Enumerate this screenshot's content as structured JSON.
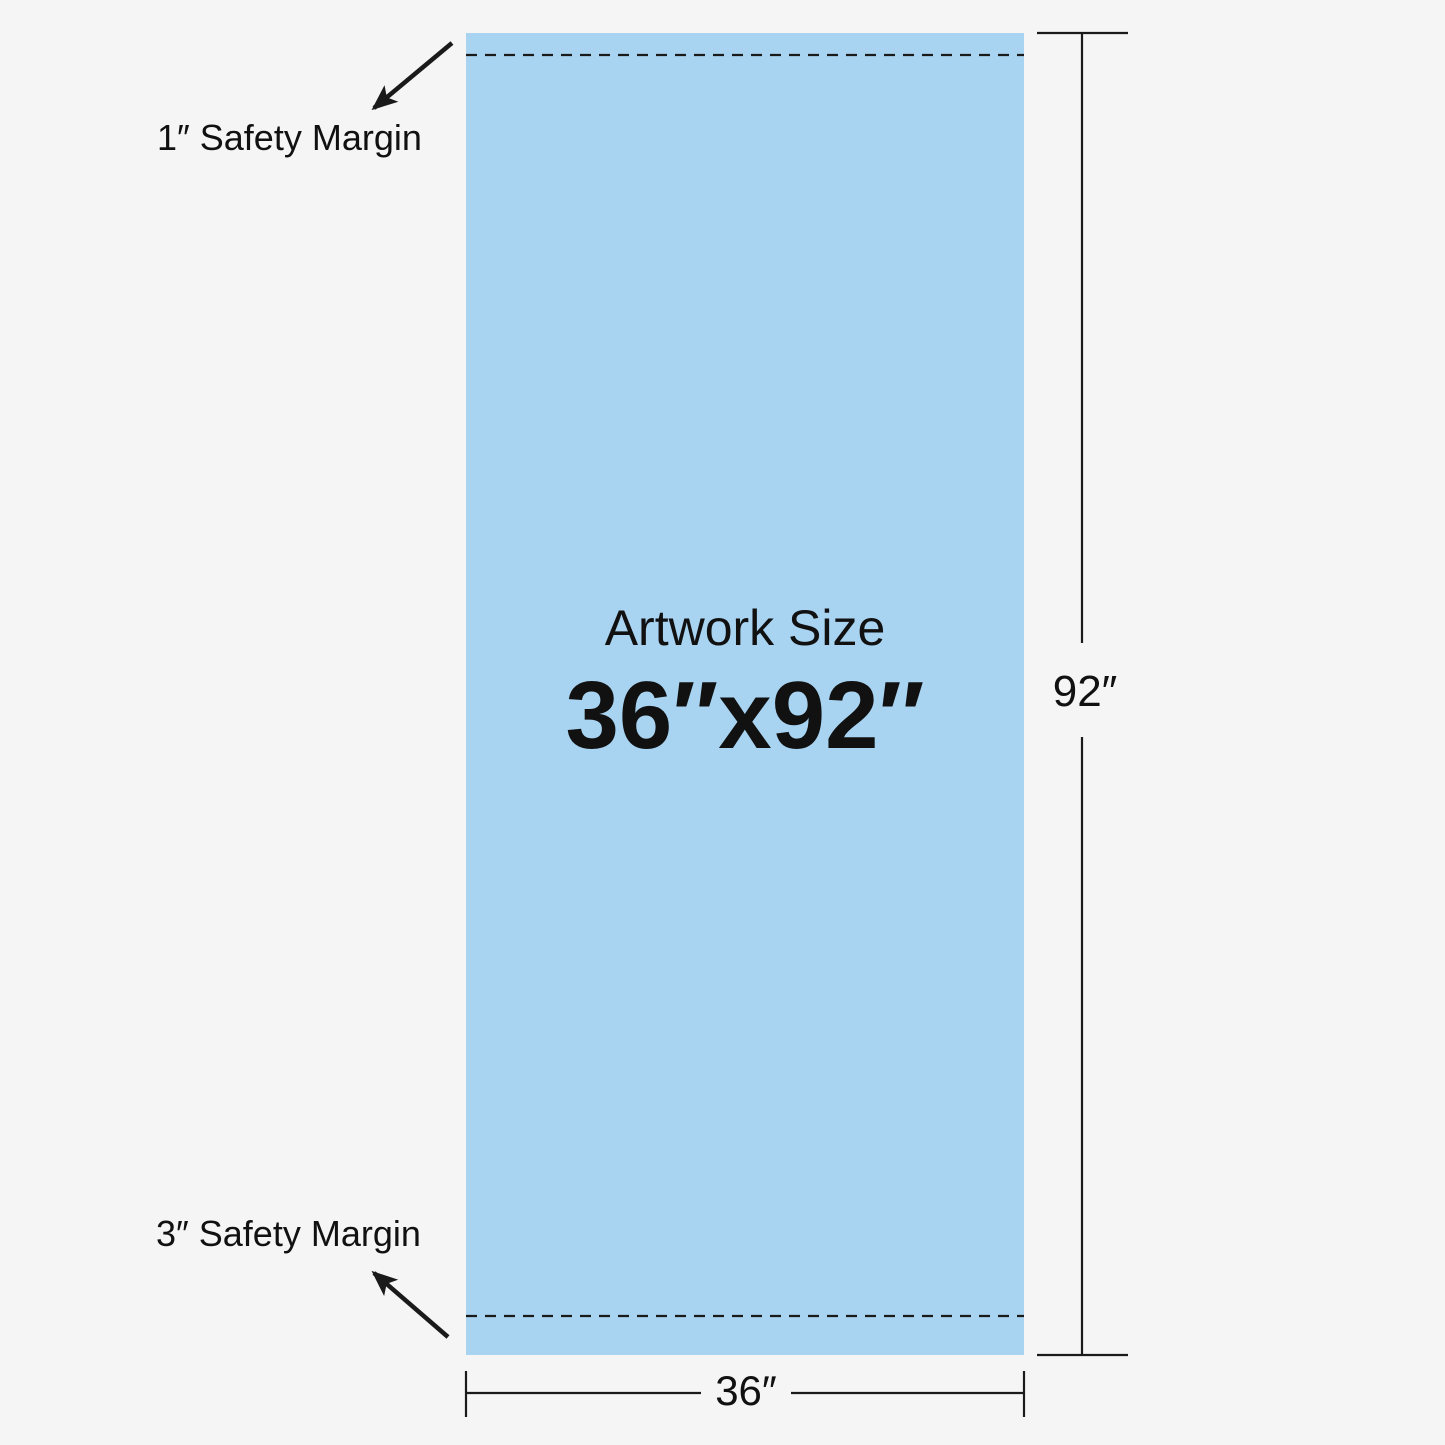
{
  "artwork": {
    "label": "Artwork Size",
    "size": "36″x92″"
  },
  "safety_margins": {
    "top_label": "1″ Safety Margin",
    "bottom_label": "3″ Safety Margin"
  },
  "dimensions": {
    "height_label": "92″",
    "width_label": "36″"
  },
  "colors": {
    "background": "#F5F5F5",
    "artwork_fill": "#A8D4F2",
    "line": "#1A1A1A",
    "text": "#111111"
  }
}
